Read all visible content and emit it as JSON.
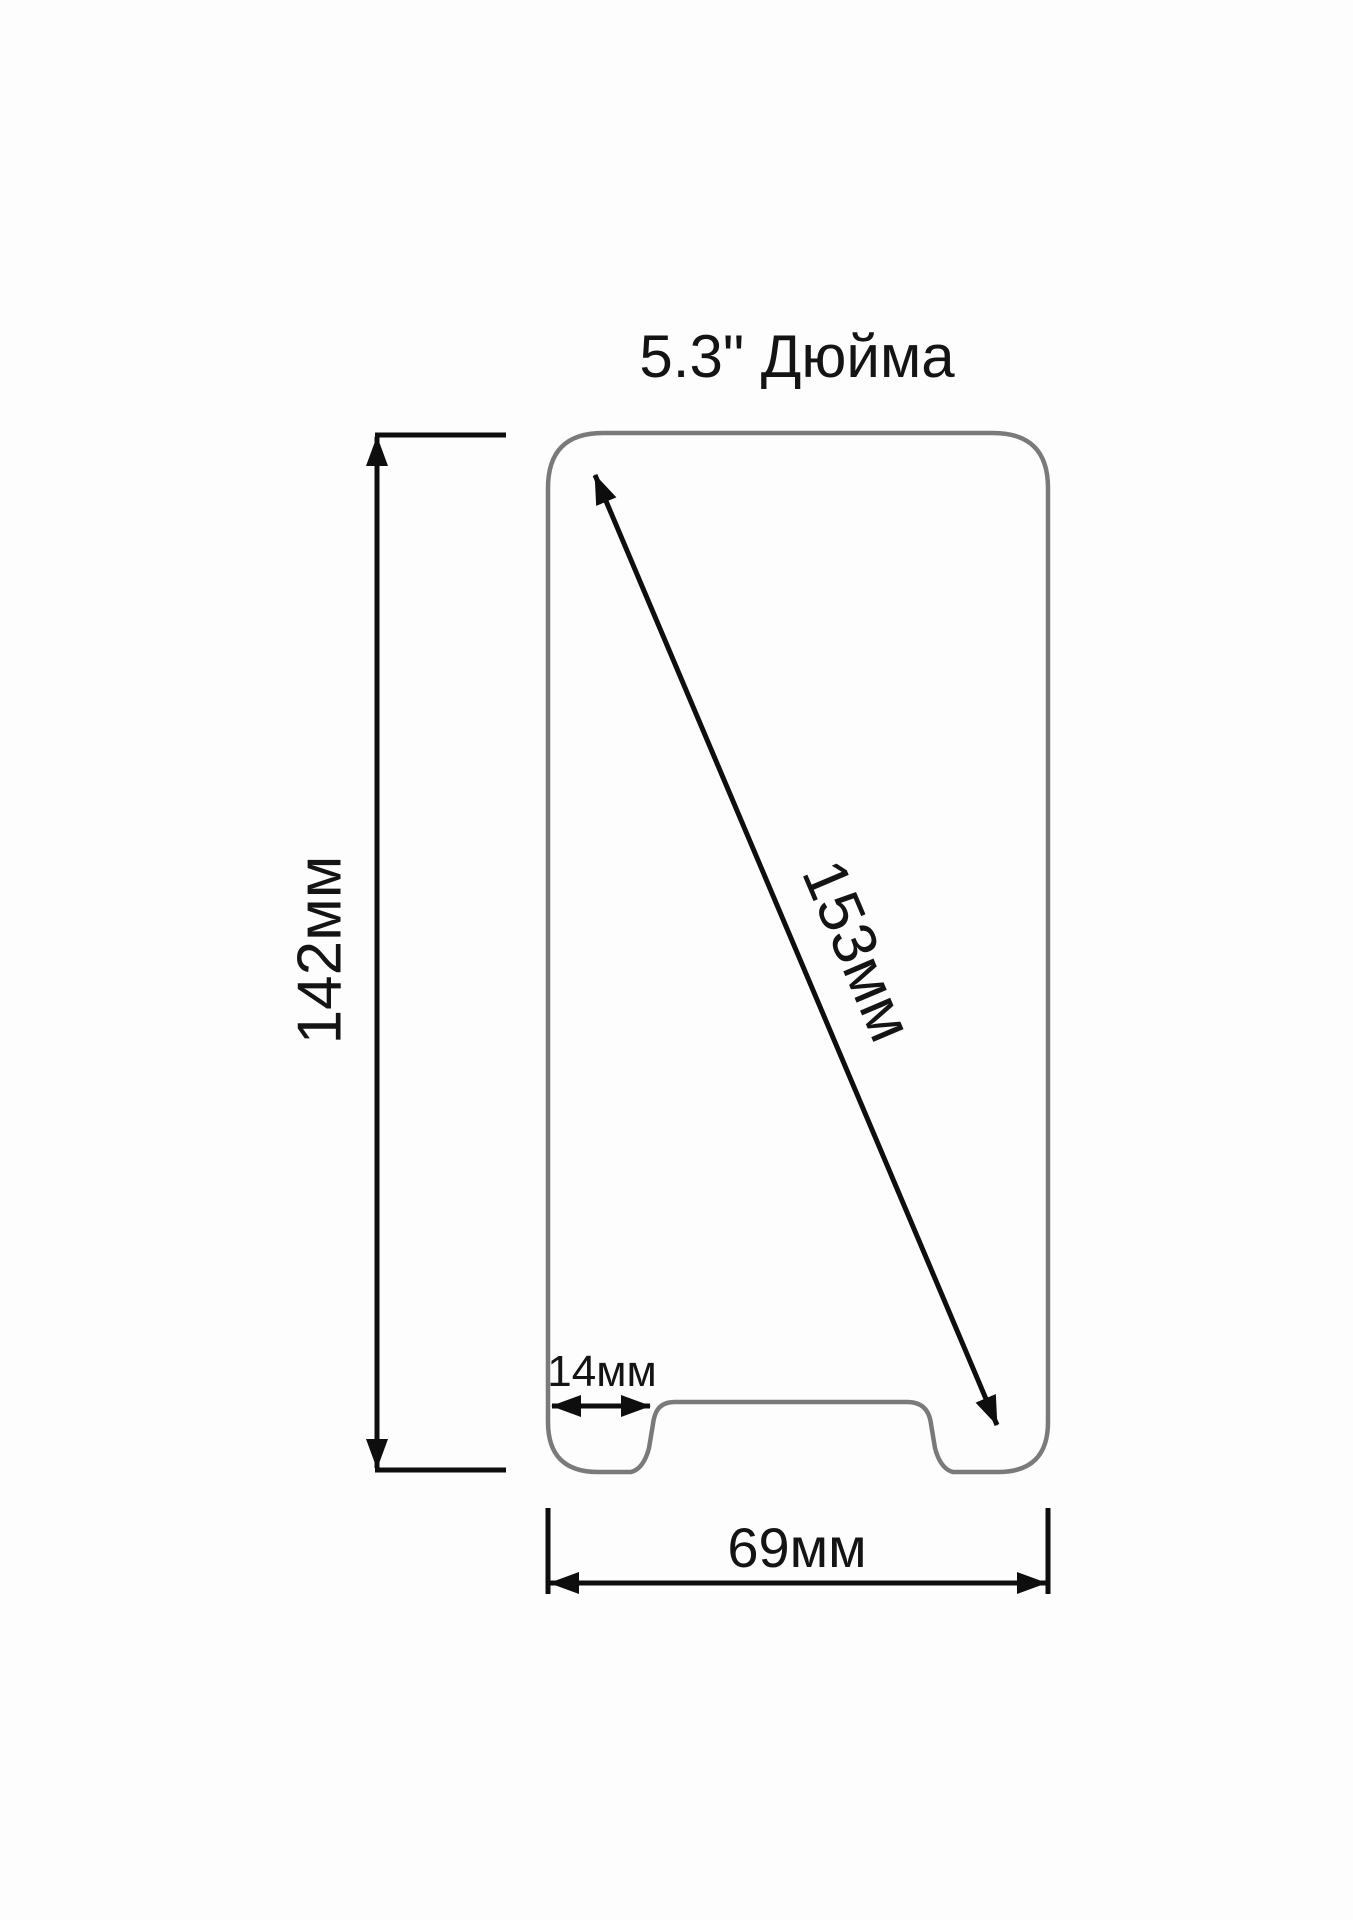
{
  "title": "5.3\" Дюйма",
  "diagram": {
    "phone": {
      "screen_diagonal_label": "153мм",
      "height_label": "142мм",
      "width_label": "69мм",
      "notch_offset_label": "14мм"
    },
    "colors": {
      "outline_gray": "#7a7a7a",
      "dimension_black": "#0e0e0e",
      "text_black": "#141414",
      "background": "#fdfdfd"
    }
  }
}
